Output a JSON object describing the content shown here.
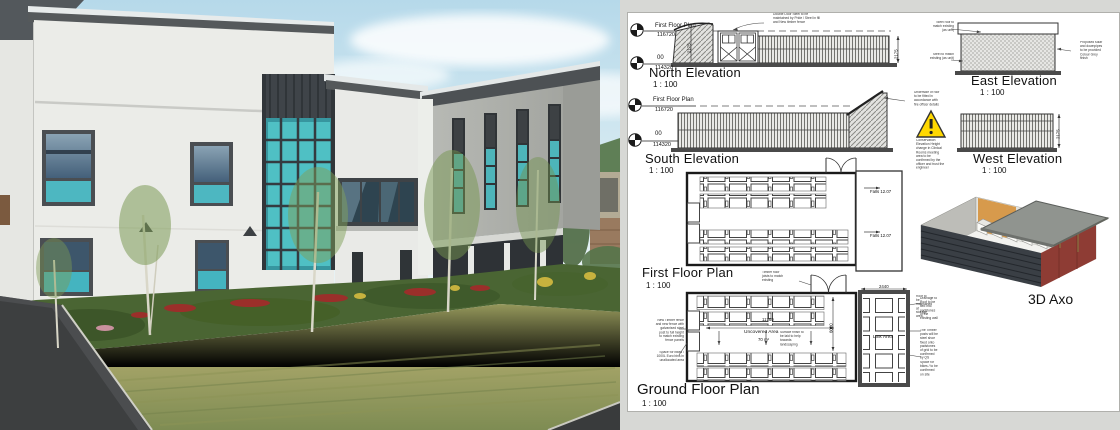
{
  "drawing": {
    "views": {
      "north": {
        "title": "North Elevation",
        "scale": "1 : 100"
      },
      "east": {
        "title": "East Elevation",
        "scale": "1 : 100"
      },
      "south": {
        "title": "South Elevation",
        "scale": "1 : 100"
      },
      "west": {
        "title": "West Elevation",
        "scale": "1 : 100"
      },
      "first_floor": {
        "title": "First Floor Plan",
        "scale": "1 : 100"
      },
      "ground_floor": {
        "title": "Ground Floor Plan",
        "scale": "1 : 100"
      },
      "axo": {
        "title": "3D Axo"
      }
    },
    "datums": {
      "first_floor": {
        "label": "First Floor Plan",
        "level": "116720"
      },
      "ground": {
        "label": "00",
        "level": "114320"
      }
    },
    "dimensions": {
      "elevation_height": "2175",
      "courtyard_length": "11760",
      "courtyard_width": "6000",
      "link_width": "2440"
    },
    "plan_labels": {
      "uncovered_area": "Uncovered Area",
      "uncovered_area_size": "70 m²",
      "link_area": "Link Area",
      "falls_1": "Falls 12.07",
      "falls_2": "Falls 12.07"
    },
    "notes": {
      "north_door": "Double Door Steel to be maintained by Pride / Steel in fill and New timber fence",
      "east_roof": "Steel roof to match existing (as unit)",
      "east_base": "Steel to match existing (as unit)",
      "east_side": "Proposed solar and downpipes to be provided Colour Grey finish",
      "south_roof": "Underside of roof to be fitted in accordance with fire officer details",
      "warning": "Conservation Elevation Height change in Clinical Rooms meeting area to be confirmed by the officer and trust the engineer",
      "ffp_door_note": "Timber floor joists to match existing",
      "gfp_left_1": "New Timber fence and new fence with galvanised steel post to full height to match existing fence panels",
      "gfp_left_2": "Space for bikes / 1000L Euro bins in unallocated area",
      "gfp_mid": "Surface finish to be laid to help towards landscaping",
      "gfp_right_1": "Drainage to Roof to be tied into padstones of the existing wall",
      "gfp_right_2": "The Timber posts will be steel shoe fixed onto padstones of grid to be confirmed by QS",
      "gfp_right_3": "Space for bikes / to be confirmed on site",
      "axo_note": "Roof to be maintained at storage area"
    }
  }
}
